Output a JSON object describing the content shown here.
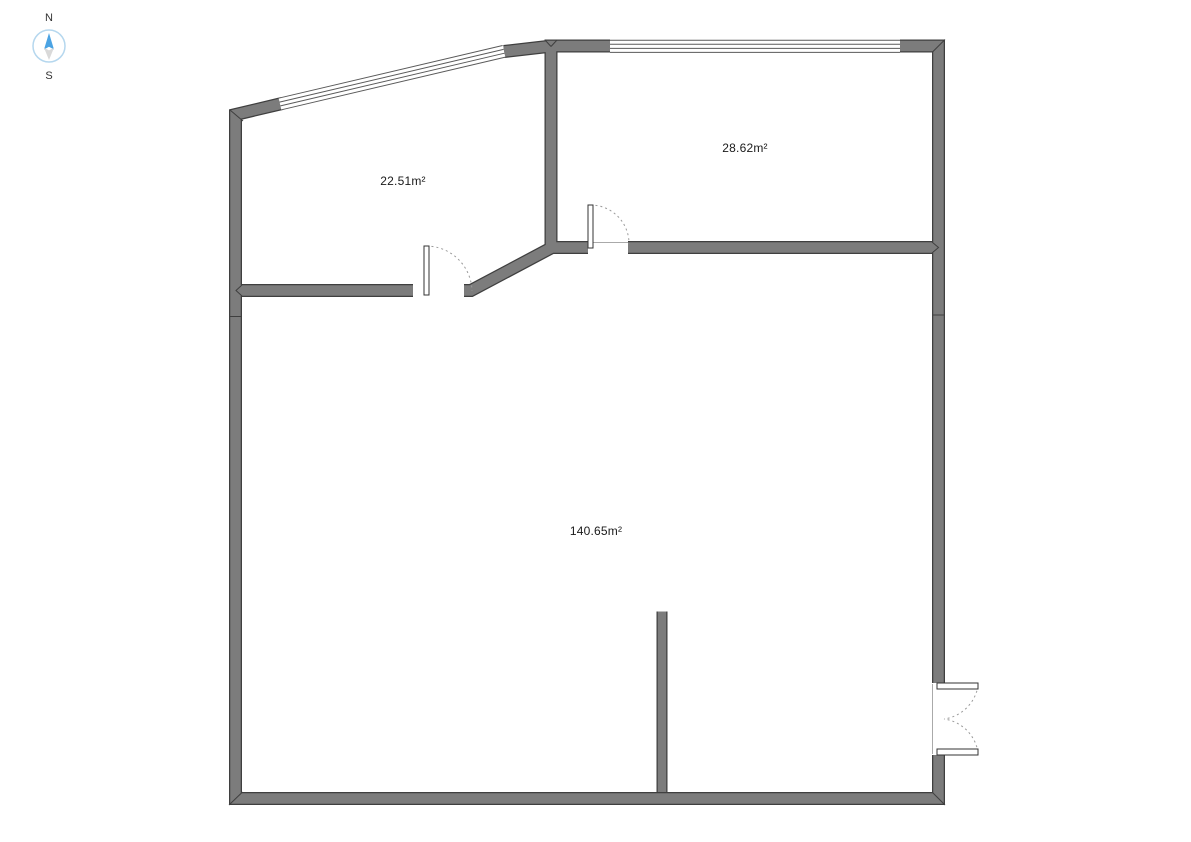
{
  "page": {
    "background": "#ffffff",
    "description_label": "floor-plan"
  },
  "compass": {
    "north_label": "N",
    "south_label": "S",
    "needle_color": "#4ba3e3",
    "south_needle_color": "#d9d9d9",
    "ring_color": "#b5d7ee"
  },
  "rooms": [
    {
      "id": "room-northwest",
      "area_label": "22.51m²"
    },
    {
      "id": "room-northeast",
      "area_label": "28.62m²"
    },
    {
      "id": "room-main",
      "area_label": "140.65m²"
    }
  ],
  "features": {
    "windows": [
      {
        "name": "window-northwest-slanted"
      },
      {
        "name": "window-north"
      }
    ],
    "doors": [
      {
        "name": "door-room-northwest"
      },
      {
        "name": "door-room-northeast"
      },
      {
        "name": "double-door-east"
      }
    ],
    "partitions": [
      {
        "name": "partition-wall-stub"
      }
    ]
  },
  "colors": {
    "wall_fill": "#7c7c7c",
    "wall_outline": "#3f3f3f",
    "window_line": "#5a5a5a",
    "door_arc": "#9a9a9a",
    "label_text": "#1a1a1a"
  }
}
